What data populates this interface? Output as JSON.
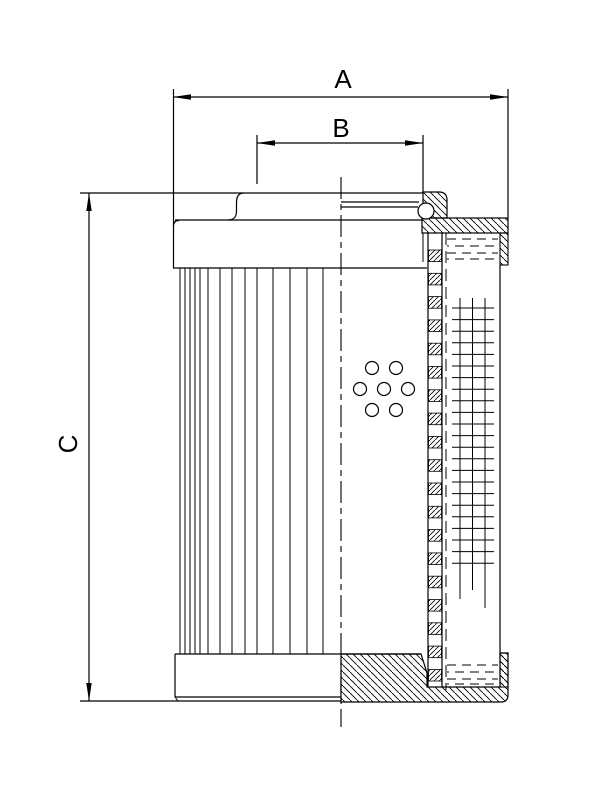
{
  "dimensions": {
    "a_label": "A",
    "b_label": "B",
    "c_label": "C"
  },
  "colors": {
    "line": "#000000",
    "background": "#ffffff"
  }
}
